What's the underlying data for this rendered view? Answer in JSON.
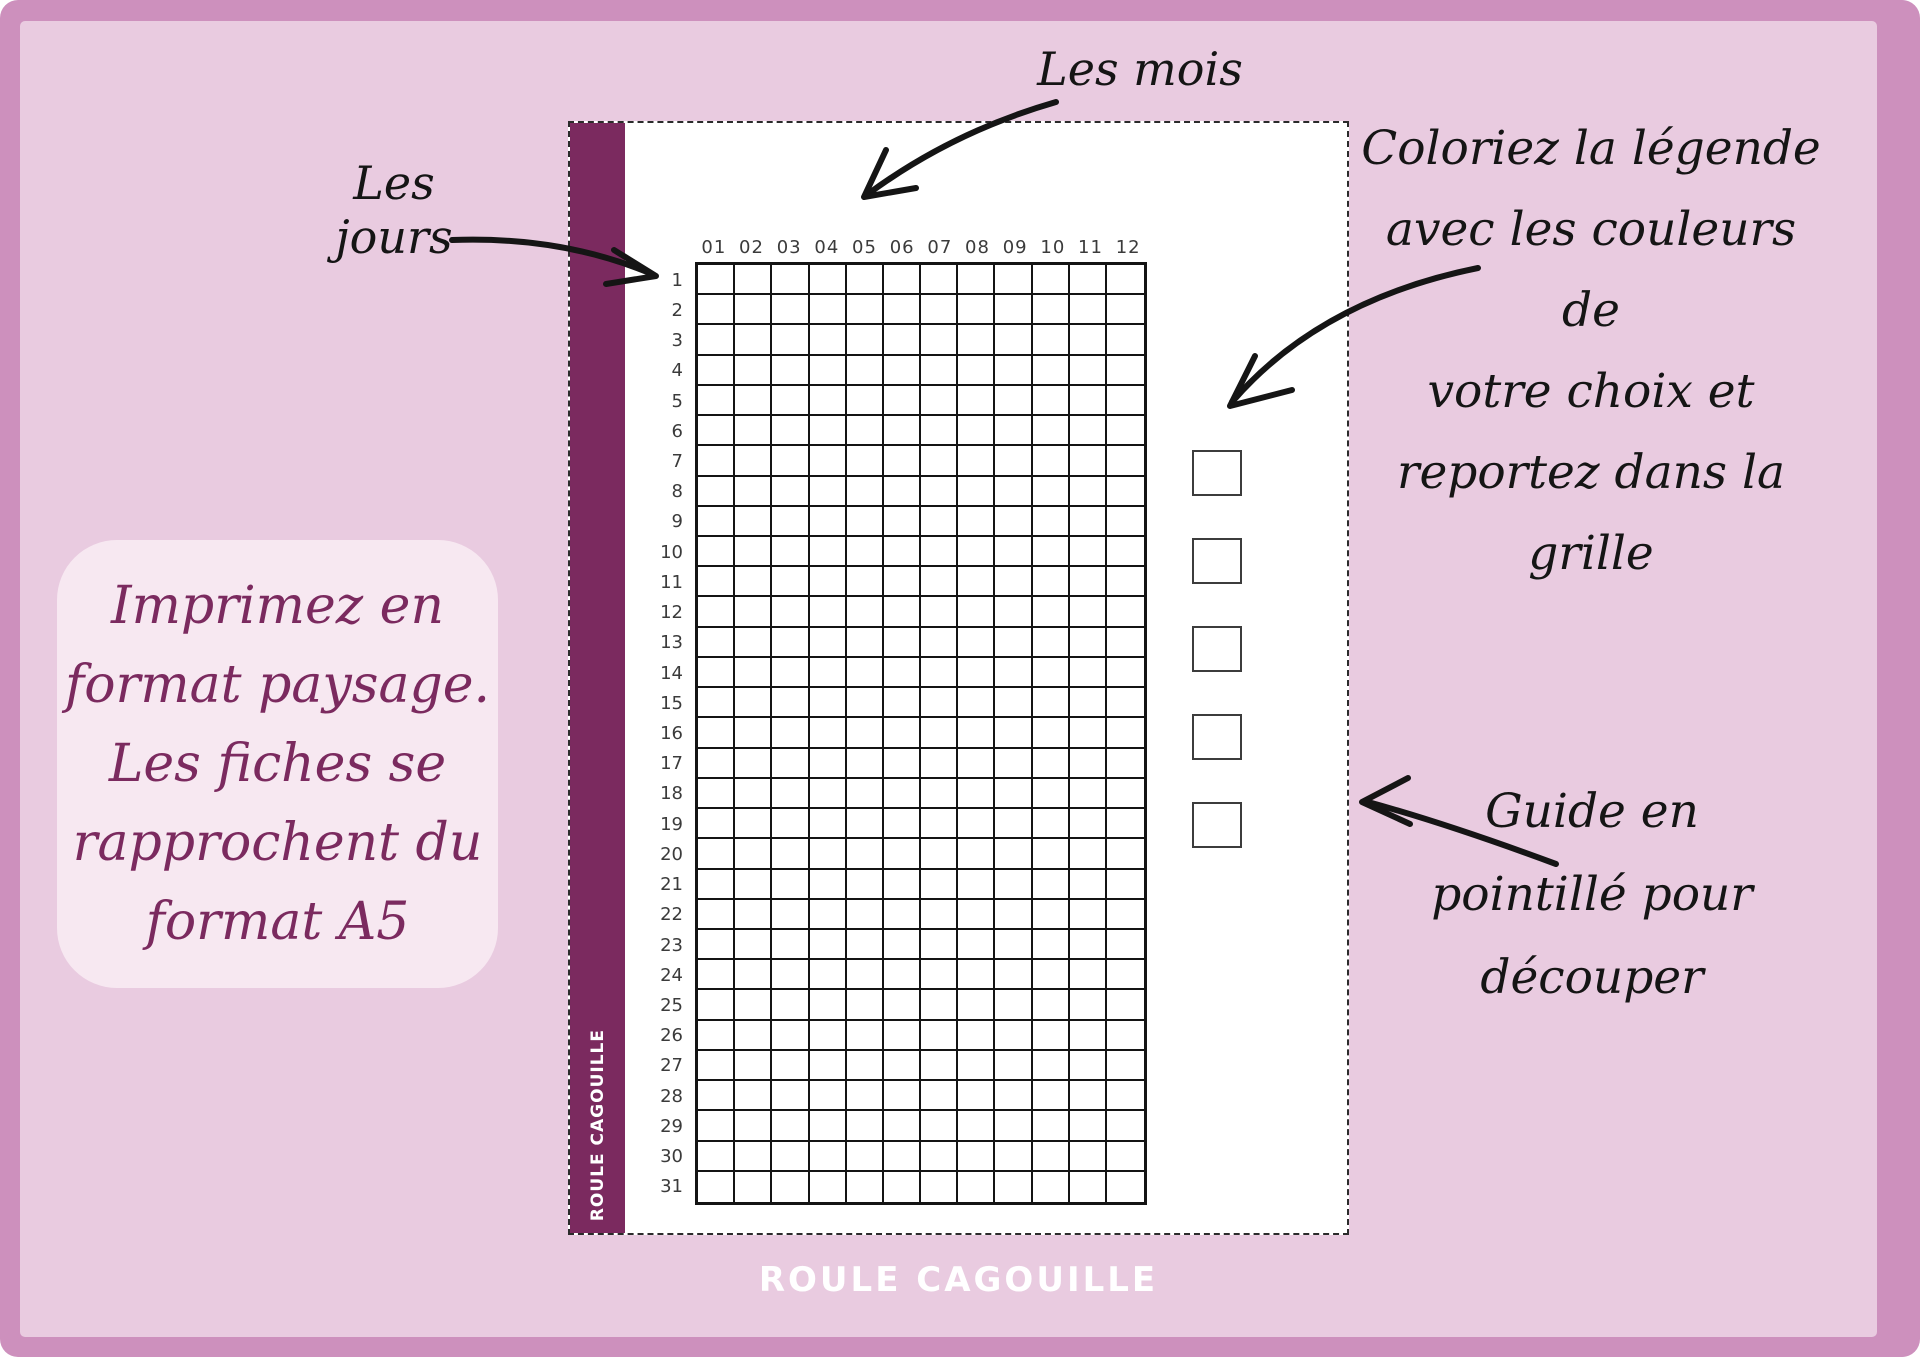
{
  "poster": {
    "months_label": "Les mois",
    "days_label": "Les jours",
    "legend_note": {
      "lines": [
        "Coloriez la légende",
        "avec les couleurs de",
        "votre choix et",
        "reportez dans la grille"
      ]
    },
    "cut_note": {
      "lines": [
        "Guide en",
        "pointillé pour",
        "découper"
      ]
    },
    "print_note": {
      "lines": [
        "Imprimez en",
        "format paysage.",
        "Les fiches se",
        "rapprochent du",
        "format A5"
      ]
    },
    "footer_wordmark": "ROULE CAGOUILLE"
  },
  "tracker": {
    "spine_text": "ROULE CAGOUILLE",
    "month_headers": [
      "01",
      "02",
      "03",
      "04",
      "05",
      "06",
      "07",
      "08",
      "09",
      "10",
      "11",
      "12"
    ],
    "day_labels": [
      "1",
      "2",
      "3",
      "4",
      "5",
      "6",
      "7",
      "8",
      "9",
      "10",
      "11",
      "12",
      "13",
      "14",
      "15",
      "16",
      "17",
      "18",
      "19",
      "20",
      "21",
      "22",
      "23",
      "24",
      "25",
      "26",
      "27",
      "28",
      "29",
      "30",
      "31"
    ],
    "legend_box_count": 5
  },
  "colors": {
    "frame_pink": "#CD90BD",
    "background_pink": "#E9CBE0",
    "note_box_pink": "#F7E8F1",
    "plum": "#7B2A5F",
    "ink_black": "#151515",
    "paper_white": "#FFFFFF"
  }
}
